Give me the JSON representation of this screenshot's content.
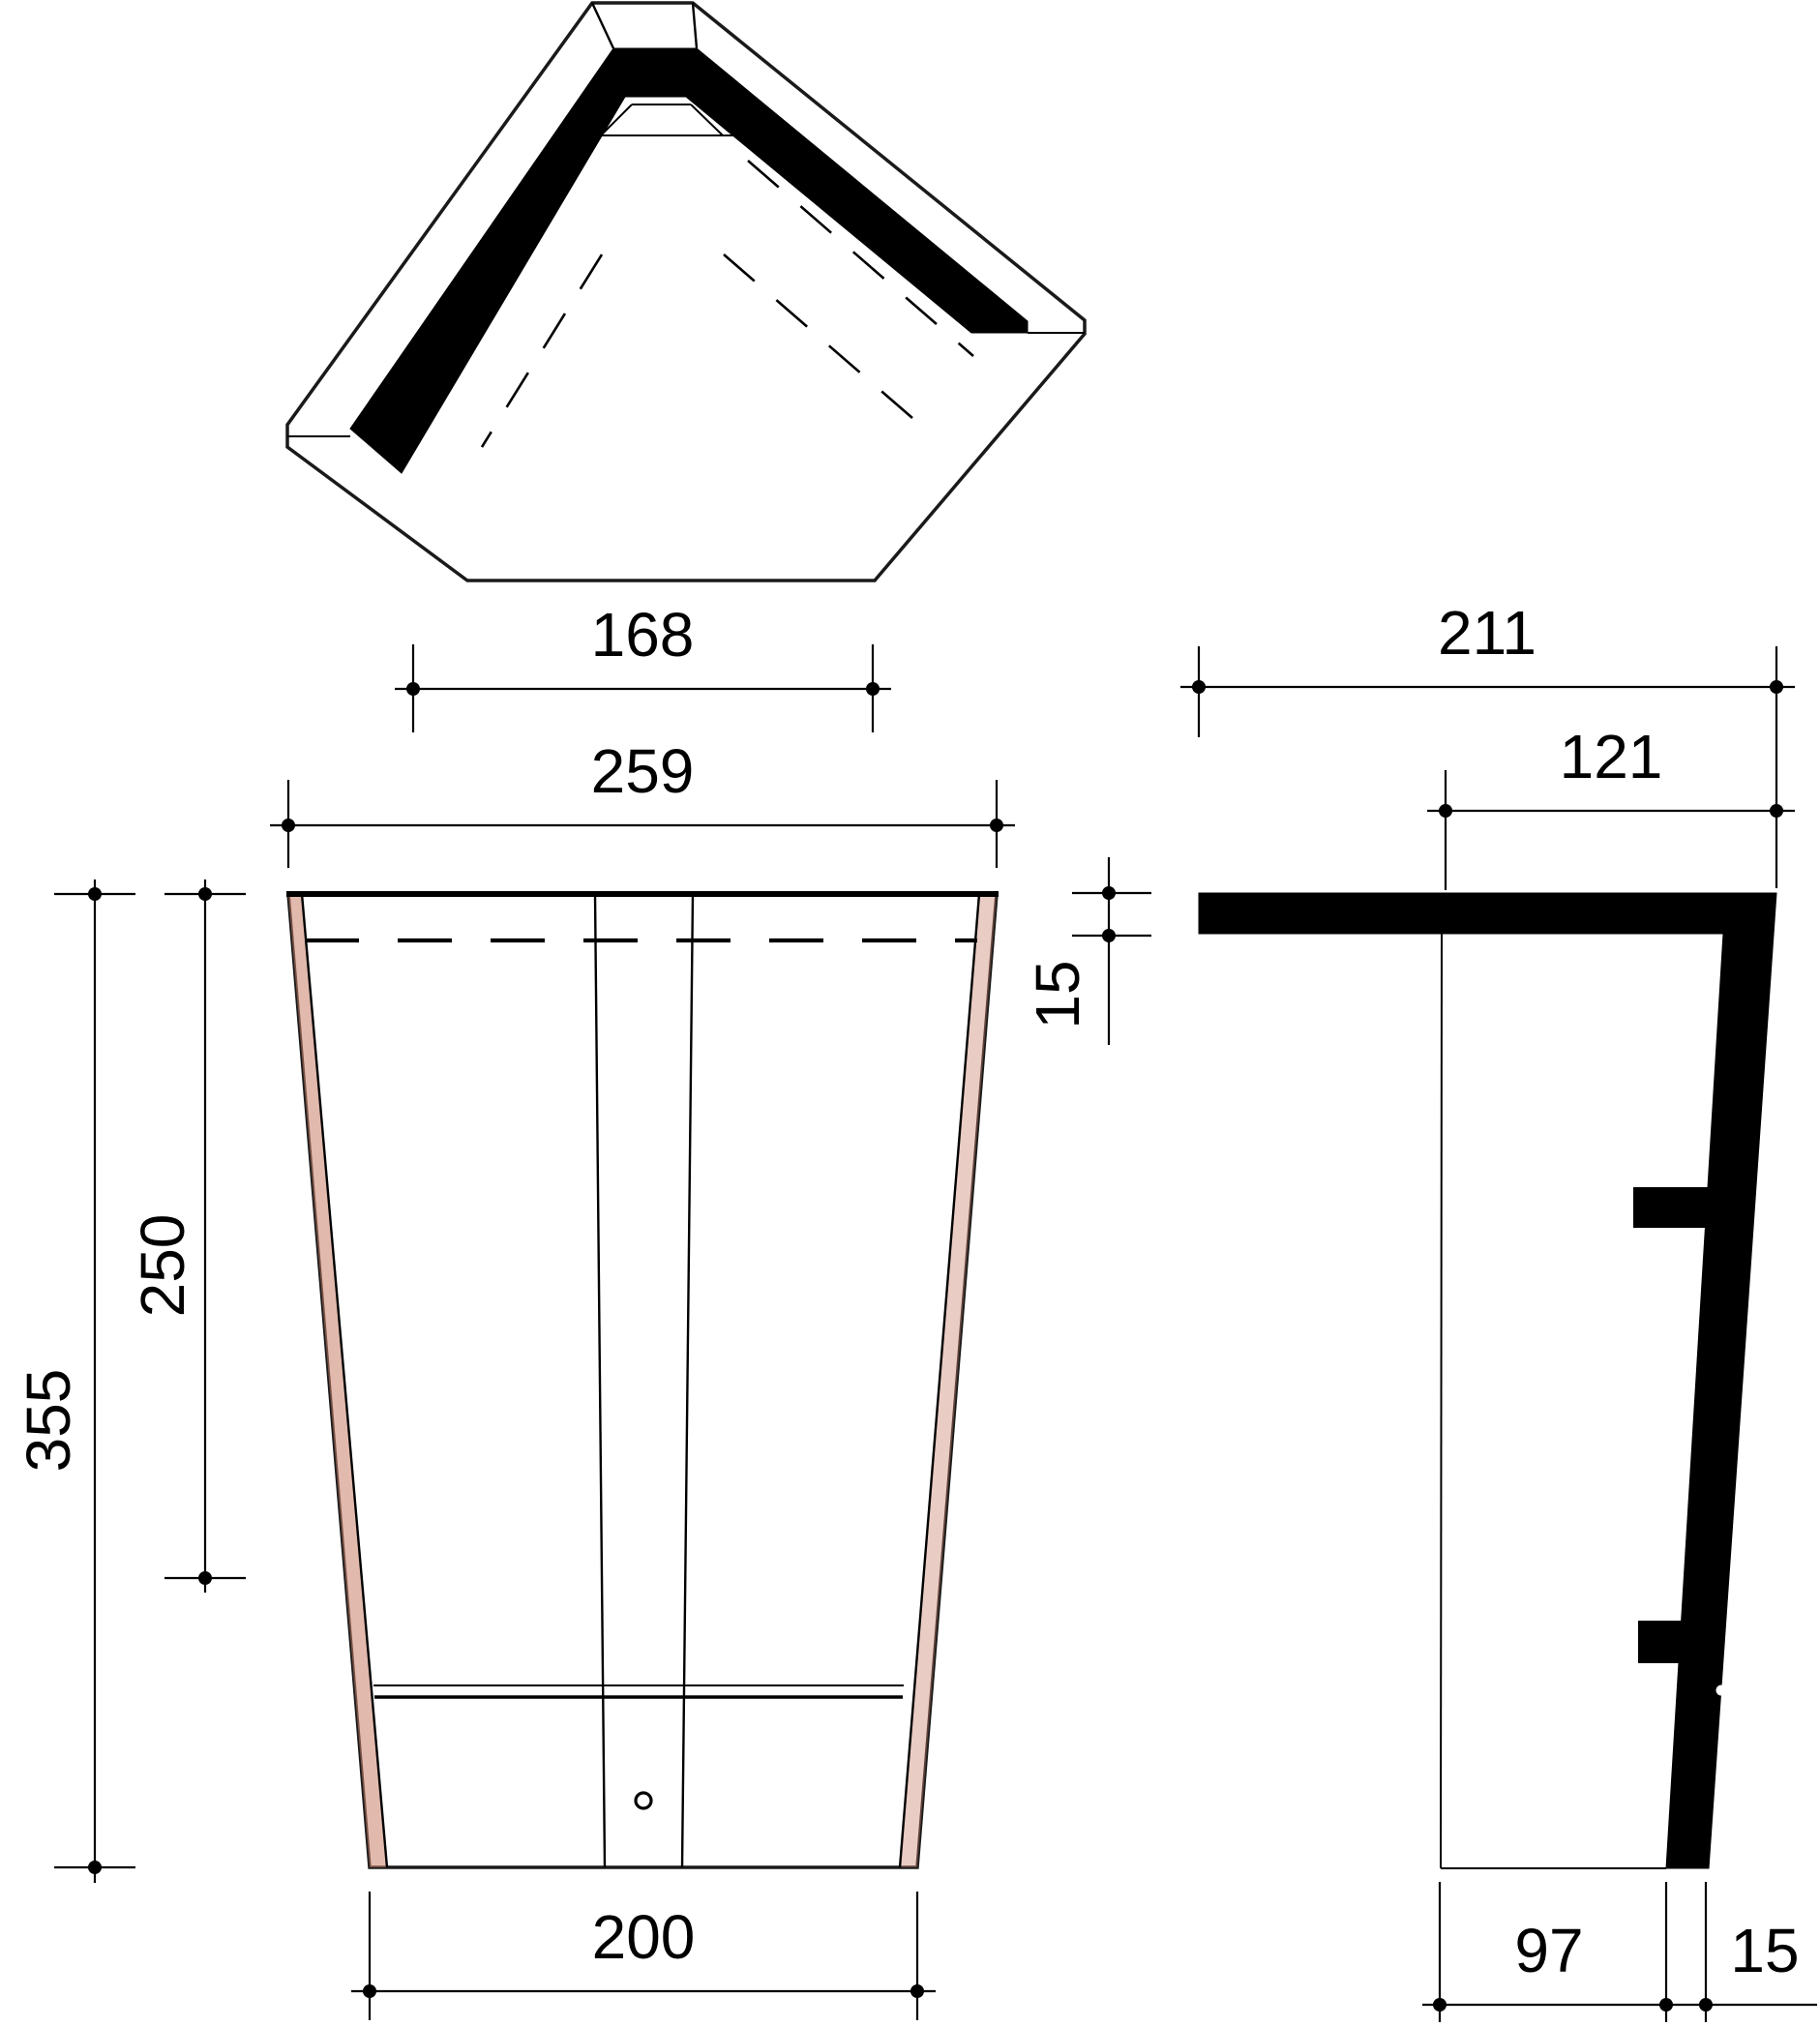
{
  "drawing": {
    "title": "roof-angle-tile-three-view-dimension-drawing",
    "background": "#ffffff",
    "line_color": "#000000",
    "tile_colors": {
      "light": "#eec5ae",
      "mid": "#e2ab92",
      "dark": "#d6927a",
      "edge_shade": "#c9806a"
    },
    "views": {
      "top": {
        "name": "top view (plan of angle tile with black glazed ridge band)"
      },
      "front": {
        "name": "front view (tapered tile face)"
      },
      "side": {
        "name": "side view (profile with nibs)"
      }
    },
    "dims": {
      "top_width": {
        "value": "168"
      },
      "front_top_width": {
        "value": "259"
      },
      "front_height_total": {
        "value": "355"
      },
      "front_height_upper": {
        "value": "250"
      },
      "front_head_overlap": {
        "value": "15"
      },
      "front_bottom_width": {
        "value": "200"
      },
      "side_top_width": {
        "value": "211"
      },
      "side_inner_width": {
        "value": "121"
      },
      "side_bottom_width": {
        "value": "97"
      },
      "side_thickness": {
        "value": "15"
      }
    }
  }
}
